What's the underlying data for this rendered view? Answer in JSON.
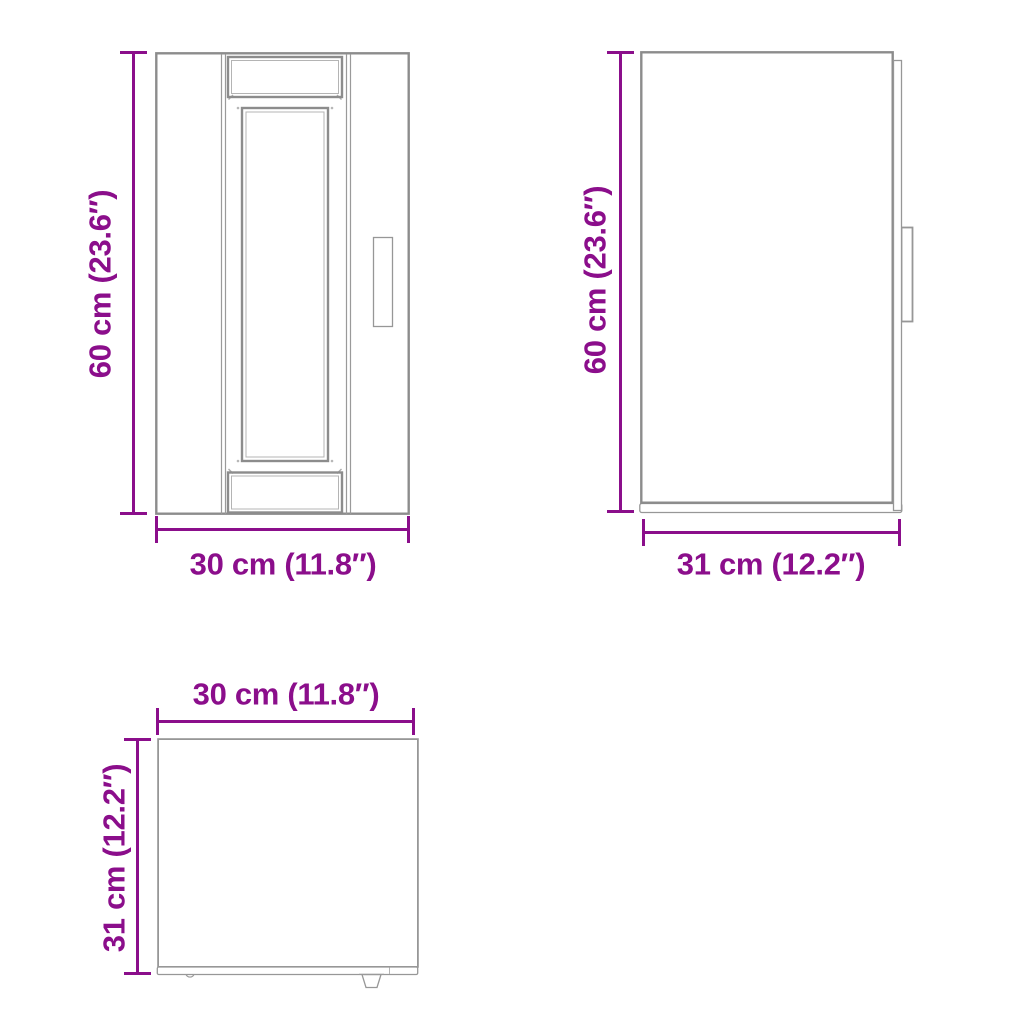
{
  "colors": {
    "accent": "#8B0E8B",
    "line": "#8c8c8c"
  },
  "views": {
    "front": {
      "height_label": "60 cm (23.6″)",
      "width_label": "30 cm (11.8″)"
    },
    "side": {
      "height_label": "60 cm (23.6″)",
      "width_label": "31 cm (12.2″)"
    },
    "top": {
      "width_label": "30 cm (11.8″)",
      "depth_label": "31 cm (12.2″)"
    }
  }
}
